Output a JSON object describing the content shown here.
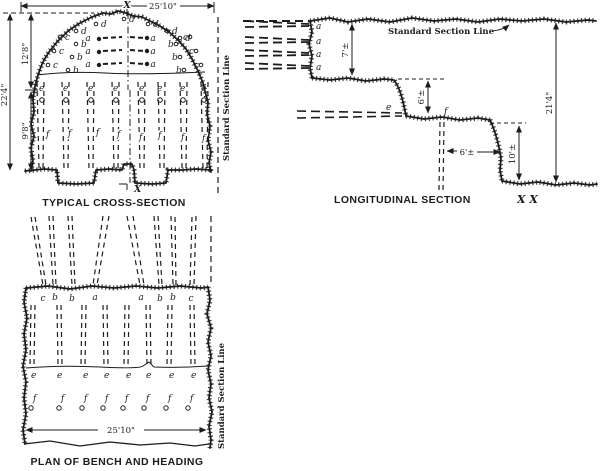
{
  "cross_section": {
    "caption": "TYPICAL CROSS-SECTION",
    "width_dim": "25'10\"",
    "total_height_dim": "22'4\"",
    "heading_height_dim": "12'8\"",
    "bench_height_dim": "9'8\"",
    "section_line_label": "Standard Section Line",
    "section_marker": "X",
    "letters": {
      "a": "a",
      "b": "b",
      "c": "c",
      "d": "d",
      "e": "e",
      "f": "f"
    }
  },
  "longitudinal_section": {
    "caption": "LONGITUDINAL SECTION",
    "caption_marker": "X X",
    "section_line_label": "Standard Section Line",
    "heading_height_dim": "7'±",
    "upper_bench_dim": "6'±",
    "burden_dim": "6'±",
    "lower_bench_dim": "10'±",
    "total_height_dim": "21'4\"",
    "letters": {
      "a": "a",
      "e": "e",
      "f": "f"
    }
  },
  "plan": {
    "caption": "PLAN OF BENCH AND HEADING",
    "width_dim": "25'10\"",
    "section_line_label": "Standard Section Line",
    "face_row": [
      "c",
      "b",
      "b",
      "a",
      "a",
      "b",
      "b",
      "c"
    ],
    "letters": {
      "e": "e",
      "f": "f"
    }
  }
}
